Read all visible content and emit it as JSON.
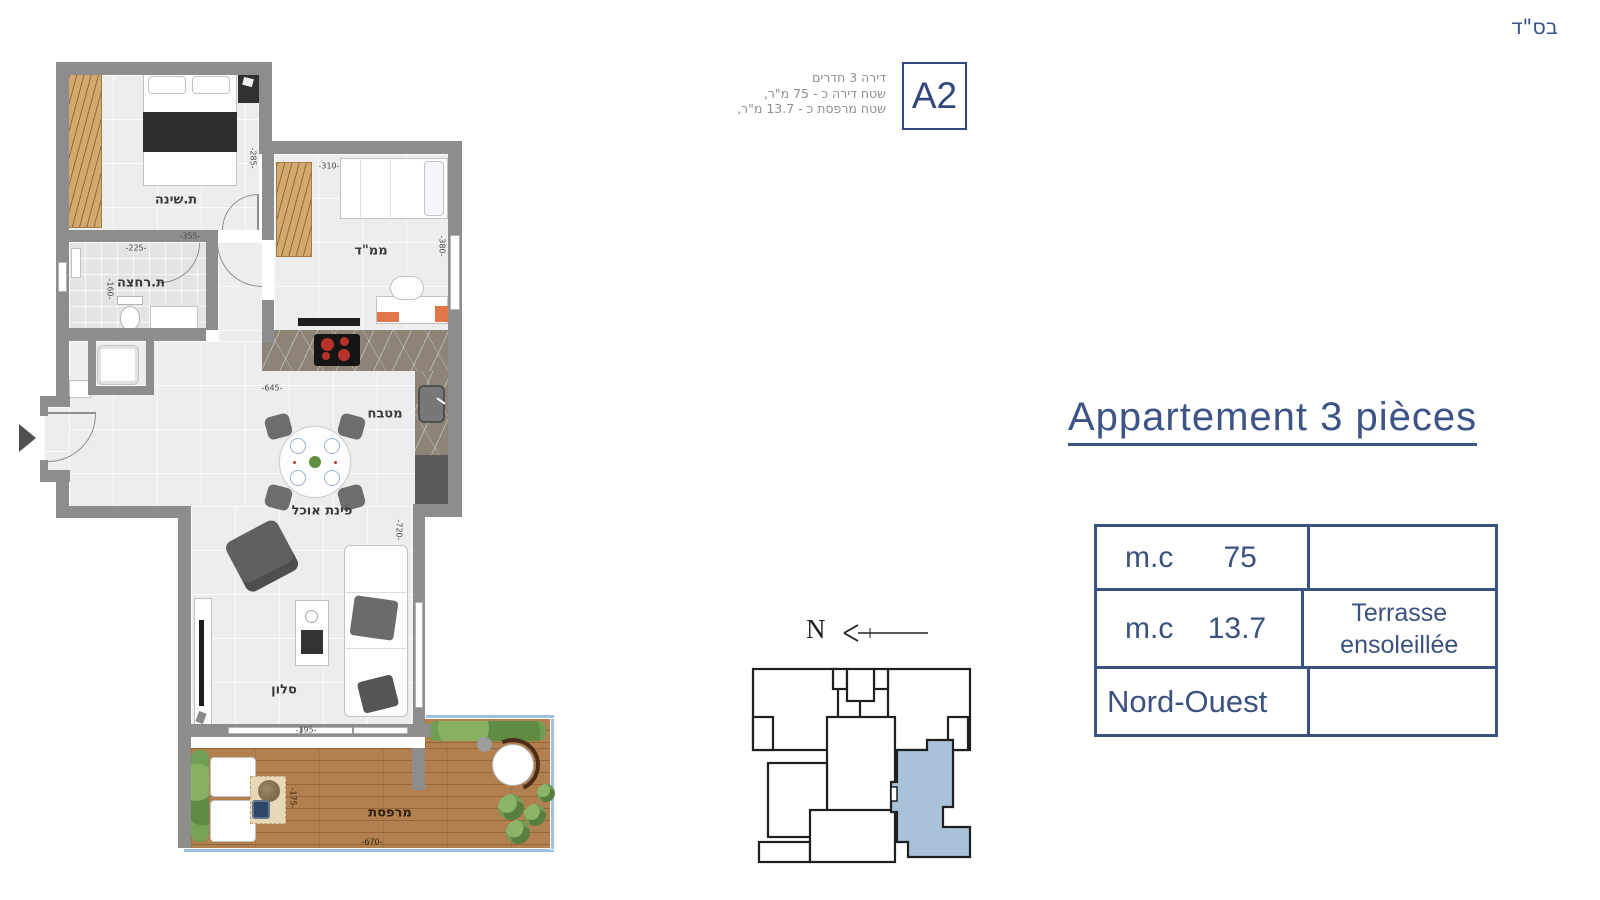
{
  "meta": {
    "bsd": "בס\"ד"
  },
  "header": {
    "lines": [
      "דירה 3 חדרים",
      "שטח דירה כ - 75 מ\"ר,",
      "שטח מרפסת כ - 13.7 מ\"ר,"
    ],
    "unit": "A2"
  },
  "title": "Appartement 3 pièces",
  "spec_table": {
    "rows": [
      {
        "unit": "m.c",
        "value": "75",
        "note": ""
      },
      {
        "unit": "m.c",
        "value": "13.7",
        "note": "Terrasse ensoleillée"
      },
      {
        "unit": "Nord-Ouest",
        "value": "",
        "note": ""
      }
    ]
  },
  "compass": {
    "north": "N"
  },
  "plan": {
    "rooms": {
      "bedroom": "ת.שינה",
      "bathroom": "ת.רחצה",
      "mamad": "ממ\"ד",
      "kitchen": "מטבח",
      "dining": "פינת אוכל",
      "living": "סלון",
      "terrace": "מרפסת"
    },
    "dims": {
      "bedroom_w": "-355-",
      "bedroom_h": "-285-",
      "bath_w": "-225-",
      "bath_h": "-160-",
      "mamad_w": "-310-",
      "mamad_h": "-380-",
      "kitchen_w": "-645-",
      "living_h": "-720-",
      "living_w": "-395-",
      "terrace_h": "-175-",
      "terrace_w": "-670-"
    }
  },
  "colors": {
    "accent": "#3b5180",
    "wall": "#8d8d8d",
    "wood": "#d3a96f",
    "deck": "#b2804e",
    "plant": "#6f9e54",
    "railing": "#9fc0d6",
    "keyplan_highlight": "#a9c2d9"
  }
}
